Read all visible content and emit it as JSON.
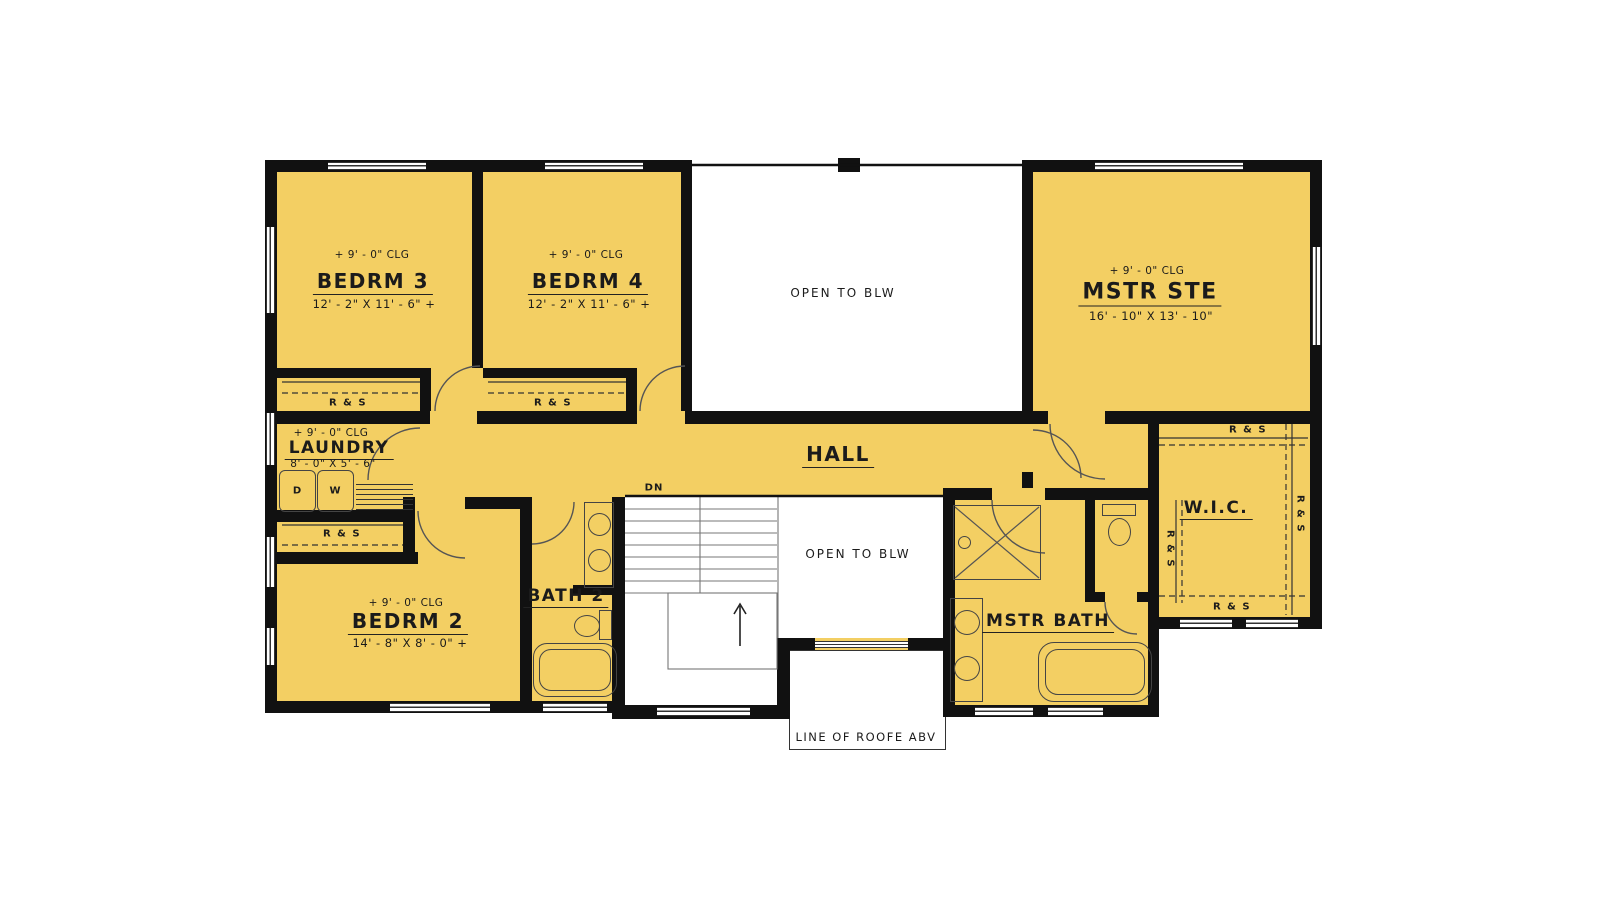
{
  "colors": {
    "room_fill": "#F3CF63",
    "wall": "#111111",
    "line": "#444444"
  },
  "rooms": {
    "bedrm3": {
      "ceiling": "+ 9' - 0\" CLG",
      "name": "BEDRM 3",
      "dims": "12' - 2\" X 11' - 6\" +"
    },
    "bedrm4": {
      "ceiling": "+ 9' - 0\" CLG",
      "name": "BEDRM 4",
      "dims": "12' - 2\" X 11' - 6\" +"
    },
    "mstr_ste": {
      "ceiling": "+ 9' - 0\" CLG",
      "name": "MSTR STE",
      "dims": "16' - 10\" X 13' - 10\""
    },
    "laundry": {
      "ceiling": "+ 9' - 0\" CLG",
      "name": "LAUNDRY",
      "dims": "8' - 0\" X 5' - 6\""
    },
    "bedrm2": {
      "ceiling": "+ 9' - 0\" CLG",
      "name": "BEDRM 2",
      "dims": "14' - 8\" X 8' - 0\" +"
    },
    "bath2": {
      "name": "BATH 2"
    },
    "mstr_bath": {
      "name": "MSTR BATH"
    },
    "wic": {
      "name": "W.I.C."
    },
    "hall": {
      "name": "HALL"
    }
  },
  "annotations": {
    "open_to_below": "OPEN TO BLW",
    "down": "DN",
    "roof_line": "LINE OF ROOFE ABV",
    "rod_and_shelf": "R & S",
    "dryer": "D",
    "washer": "W"
  }
}
